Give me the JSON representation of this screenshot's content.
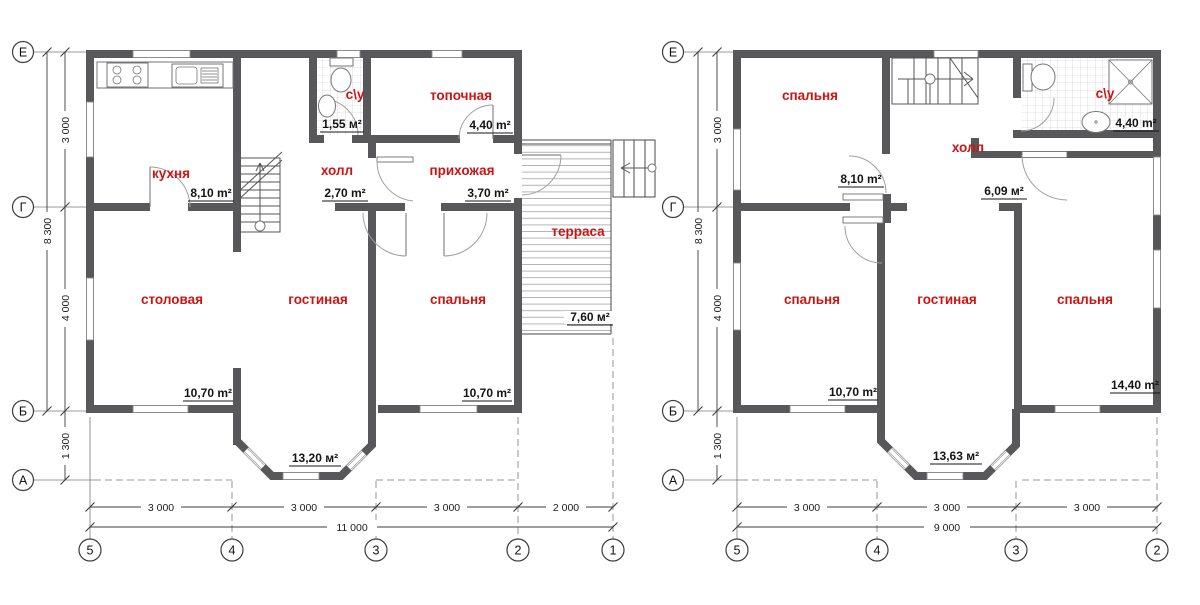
{
  "colors": {
    "wall": "#58585a",
    "accent_red": "#cc1414",
    "line": "#3c3c3c"
  },
  "floor1": {
    "rooms": {
      "kitchen": {
        "label": "кухня",
        "area": "8,10 m²"
      },
      "wc": {
        "label": "с\\у",
        "area": "1,55 м²"
      },
      "hall": {
        "label": "холл",
        "area": "2,70 m²"
      },
      "boiler": {
        "label": "топочная",
        "area": "4,40 m²"
      },
      "entry": {
        "label": "прихожая",
        "area": "3,70 m²"
      },
      "terrace": {
        "label": "терраса",
        "area": "7,60 м²"
      },
      "dining": {
        "label": "столовая",
        "area": "10,70 m²"
      },
      "living": {
        "label": "гостиная",
        "area": "13,20 м²"
      },
      "bedroom": {
        "label": "спальня",
        "area": "10,70 m²"
      }
    },
    "dims": {
      "w1": "3 000",
      "w2": "3 000",
      "w3": "3 000",
      "w4": "2 000",
      "w_total": "11 000",
      "h1": "3 000",
      "h2": "4 000",
      "h3": "1 300",
      "h_total": "8 300"
    },
    "axis_rows": [
      "Е",
      "Г",
      "Б",
      "А"
    ],
    "axis_cols": [
      "5",
      "4",
      "3",
      "2",
      "1"
    ]
  },
  "floor2": {
    "rooms": {
      "bedroom1": {
        "label": "спальня",
        "area": "8,10 m²"
      },
      "hall": {
        "label": "холл",
        "area": "6,09 м²"
      },
      "wc": {
        "label": "с\\у",
        "area": "4,40 m²"
      },
      "bedroom2": {
        "label": "спальня",
        "area": "10,70 m²"
      },
      "living": {
        "label": "гостиная",
        "area": "13,63 м²"
      },
      "bedroom3": {
        "label": "спальня",
        "area": "14,40 m²"
      }
    },
    "dims": {
      "w1": "3 000",
      "w2": "3 000",
      "w3": "3 000",
      "w_total": "9 000",
      "h1": "3 000",
      "h2": "4 000",
      "h3": "1 300",
      "h_total": "8 300"
    },
    "axis_rows": [
      "Е",
      "Г",
      "Б",
      "А"
    ],
    "axis_cols": [
      "5",
      "4",
      "3",
      "2"
    ]
  }
}
